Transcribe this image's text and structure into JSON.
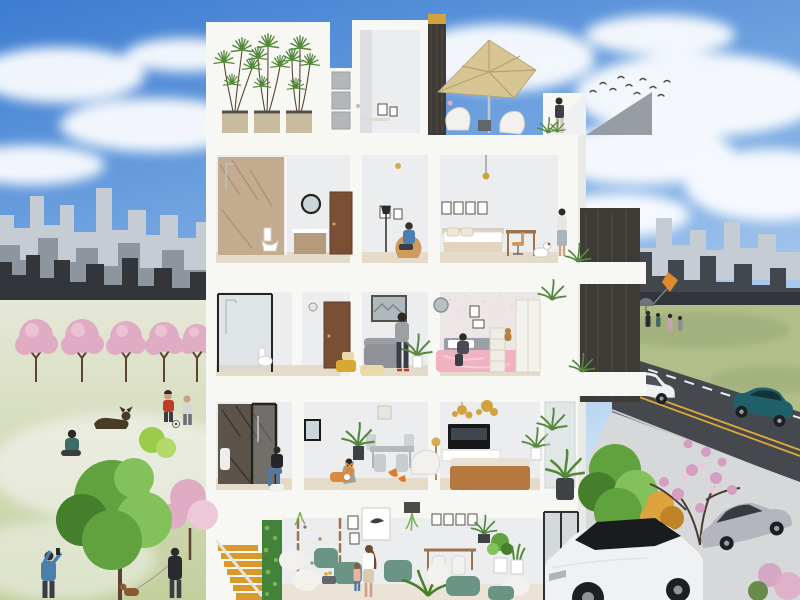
{
  "colors": {
    "sky-top": "#3c7cd0",
    "sky-mid": "#85b2e6",
    "sky-pale": "#dcebf8",
    "cloud": "#ffffff",
    "skyline-far": "#c6ccd3",
    "skyline-mid": "#8d959e",
    "skyline-near": "#32363b",
    "skyline-right": "#42474e",
    "grass-pale": "#e5e8d7",
    "grass-green": "#c3cf9d",
    "grass-patch": "#f0f1ea",
    "meadow": "#b1be8a",
    "meadow-dark": "#92a26e",
    "road": "#45484c",
    "road-yellow": "#dfa93c",
    "road-white": "#eceded",
    "pavement": "#d7d8da",
    "curb": "#bfc1c3",
    "building-white": "#f7f7f4",
    "building-shade": "#e0dfdb",
    "interior-wall": "#ebedef",
    "interior-shadow": "#dcdee1",
    "floor-wood": "#e4dbc9",
    "marble-tan": "#c2ab8e",
    "marble-streak": "#98815f",
    "marble-dark": "#5c544b",
    "marble-dark-streak": "#332e28",
    "glass": "#ccd6da",
    "frame-dark": "#26231f",
    "door-brown": "#7b4f33",
    "vent-gray": "#b4b7b9",
    "panel-gray": "#989da3",
    "umbrella": "#d7c694",
    "umbrella-rib": "#b3a26f",
    "stair-orange": "#d9992b",
    "green-wall": "#43823a",
    "plant": "#55883d",
    "plant-light": "#7fb257",
    "tree-green": "#5fa23e",
    "tree-light": "#83c15b",
    "tree-dark": "#457f2b",
    "trunk": "#5d4330",
    "blossom": "#dfacc4",
    "blossom-light": "#edc8d9",
    "magnolia": "#d49fc1",
    "bush-orange": "#dda43e",
    "bed-pink": "#f0b2c0",
    "bed-pink-light": "#f7cdd7",
    "headboard-gray": "#9aa0a6",
    "sofa-caramel": "#b5793f",
    "cushion-cream": "#e9e2d4",
    "sofa-gray": "#8e9196",
    "chair-white": "#f2f1ed",
    "chair-sage": "#6a9484",
    "chair-tan": "#cf9a5e",
    "ottoman-yellow": "#d9a832",
    "ottoman-cream": "#ead9a8",
    "tv-black": "#17181a",
    "gold": "#d2a23f",
    "wood": "#9a7350",
    "planter-tan": "#c9bc9e",
    "pot-dark": "#3f4245",
    "table-dark": "#62666a",
    "car-white": "#f0f1f2",
    "car-teal": "#20606a",
    "car-silver": "#b3b7bd",
    "car-glass": "#363b40",
    "tire": "#1d2023",
    "stone-dark": "#3e3a36",
    "stone-light": "#575249",
    "skin": "#c9a083",
    "hair-dark": "#2e2a26",
    "shirt-red": "#c0392b",
    "shirt-blue": "#4c7fae",
    "shirt-gray": "#9aa0a4",
    "shirt-teal": "#3e6b63",
    "coat-dark": "#2c2a31",
    "pants-dark": "#3a3d44",
    "jeans": "#5577a0",
    "white": "#ffffff",
    "kite-orange": "#e08a2e",
    "dog-dark": "#4a3a28",
    "dog-orange": "#d98a3f",
    "dog-brown": "#8a5a30",
    "bird": "#4a4a4a"
  }
}
